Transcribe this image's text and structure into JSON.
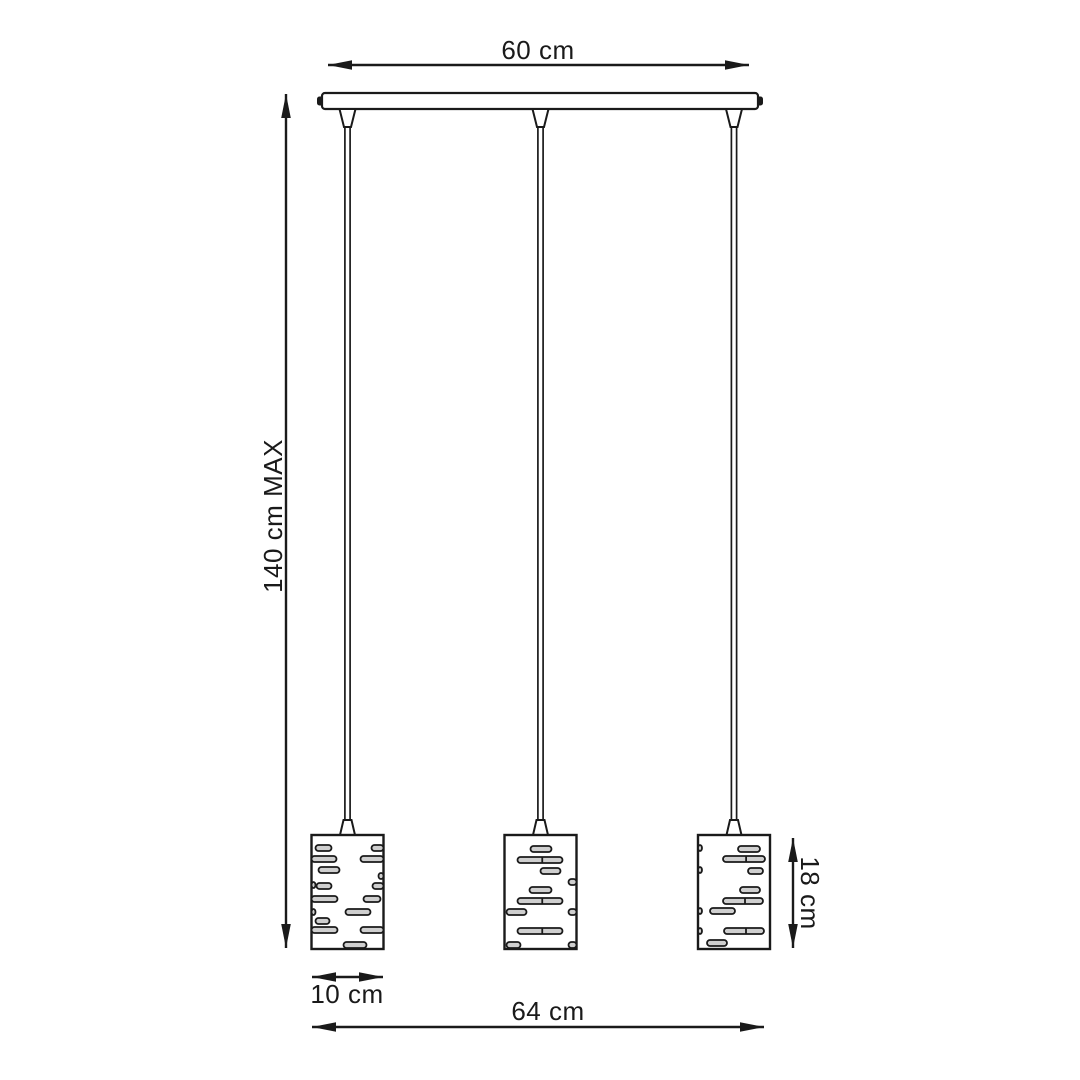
{
  "drawing": {
    "name": "3-light pendant lamp dimension diagram",
    "line_color": "#1a1a1a",
    "slot_fill": "#cfcfcf",
    "background": "#ffffff",
    "labels": {
      "canopy_width": "60 cm",
      "max_drop": "140 cm MAX",
      "shade_diameter": "10 cm",
      "shade_height": "18 cm",
      "total_width": "64 cm"
    },
    "canopy": {
      "x": 322,
      "y": 93,
      "w": 436,
      "h": 16
    },
    "shade": {
      "y": 835,
      "w": 72,
      "h": 114,
      "slot_h": 6
    },
    "cord": {
      "top_y": 109,
      "grip_top_end": 127,
      "grip_bottom_start": 820,
      "bottom_y": 835
    },
    "pendants": [
      {
        "cx": 347.5,
        "shade_x": 311.5,
        "slots": [
          [
            4,
            10,
            16
          ],
          [
            60,
            10,
            12
          ],
          [
            0,
            21,
            25
          ],
          [
            49,
            21,
            23
          ],
          [
            7,
            32,
            21
          ],
          [
            67,
            38,
            5
          ],
          [
            0,
            47,
            4
          ],
          [
            5,
            48,
            15
          ],
          [
            61,
            48,
            11
          ],
          [
            0,
            61,
            26
          ],
          [
            52,
            61,
            17
          ],
          [
            0,
            74,
            4
          ],
          [
            34,
            74,
            25
          ],
          [
            4,
            83,
            14
          ],
          [
            0,
            92,
            26
          ],
          [
            49,
            92,
            23
          ],
          [
            32,
            107,
            23
          ]
        ]
      },
      {
        "cx": 540.5,
        "shade_x": 504.5,
        "slots": [
          [
            26,
            11,
            21
          ],
          [
            13,
            22,
            45
          ],
          [
            36,
            33,
            20
          ],
          [
            64,
            44,
            8
          ],
          [
            25,
            52,
            22
          ],
          [
            13,
            63,
            45
          ],
          [
            2,
            74,
            20
          ],
          [
            64,
            74,
            8
          ],
          [
            13,
            93,
            45
          ],
          [
            2,
            107,
            14
          ],
          [
            64,
            107,
            8
          ]
        ]
      },
      {
        "cx": 734,
        "shade_x": 698,
        "slots": [
          [
            0,
            10,
            4
          ],
          [
            40,
            11,
            22
          ],
          [
            25,
            21,
            42
          ],
          [
            0,
            32,
            4
          ],
          [
            50,
            33,
            15
          ],
          [
            42,
            52,
            20
          ],
          [
            25,
            63,
            40
          ],
          [
            0,
            73,
            4
          ],
          [
            12,
            73,
            25
          ],
          [
            0,
            93,
            4
          ],
          [
            26,
            93,
            40
          ],
          [
            9,
            105,
            20
          ]
        ]
      }
    ],
    "dims": {
      "canopy_width": {
        "x1": 328,
        "x2": 749,
        "y": 65,
        "label_x": 538,
        "label_y": 59
      },
      "max_drop": {
        "x": 286,
        "y1": 94,
        "y2": 948,
        "label_x": 282,
        "label_y": 516
      },
      "shade_diameter": {
        "x1": 312,
        "x2": 383,
        "y": 977,
        "label_x": 347,
        "label_y": 1003
      },
      "total_width": {
        "x1": 312,
        "x2": 764,
        "y": 1027,
        "label_x": 548,
        "label_y": 1020
      },
      "shade_height": {
        "x": 793,
        "y1": 838,
        "y2": 948,
        "label_x": 801,
        "label_y": 893
      }
    }
  }
}
